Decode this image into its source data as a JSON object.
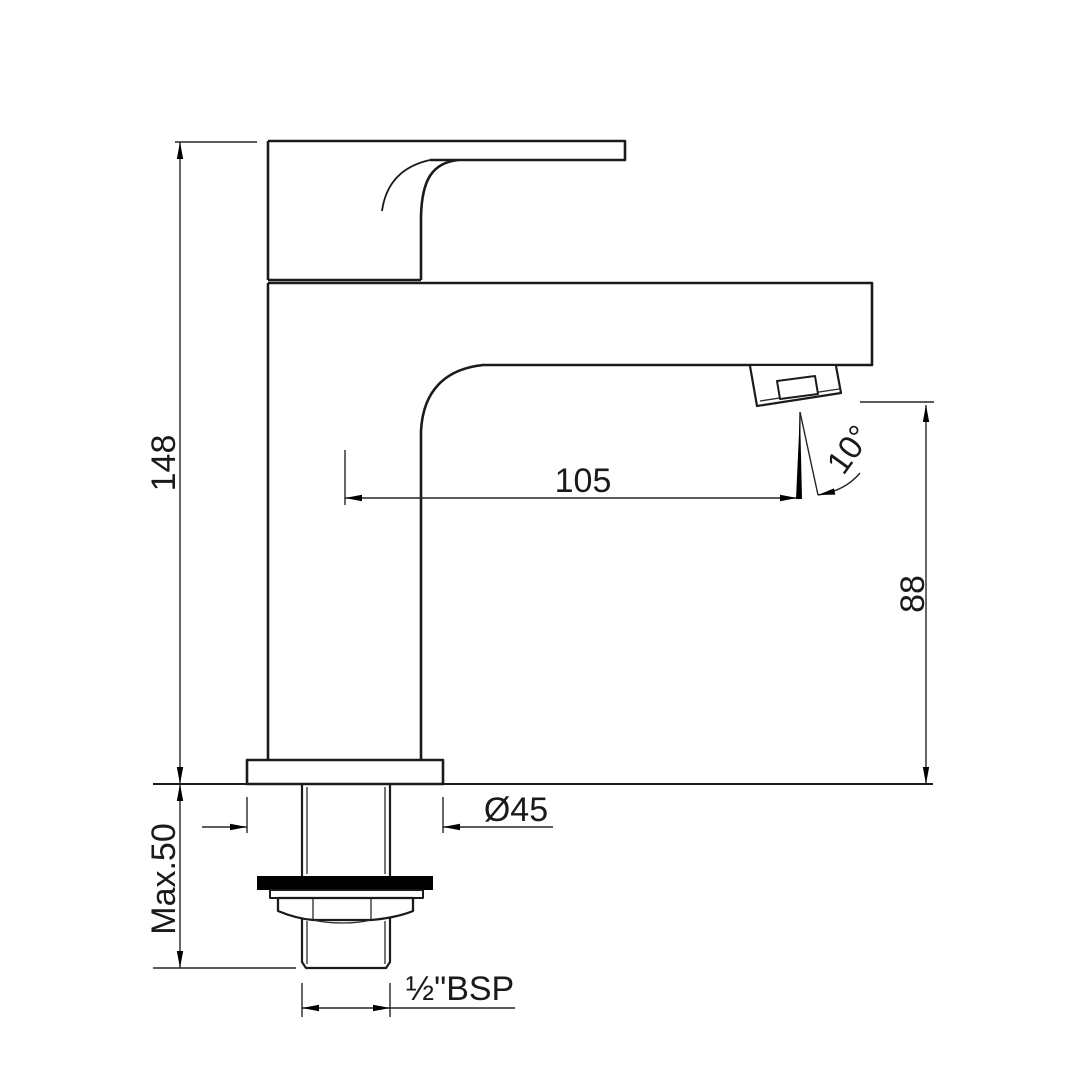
{
  "drawing": {
    "name": "single-lever-basin-mixer-dimension-drawing",
    "dimensions": {
      "height_overall": "148",
      "spout_reach": "105",
      "spout_height": "88",
      "outlet_angle": "10°",
      "base_diameter": "Ø45",
      "max_deck_thickness": "Max.50",
      "inlet_thread": "½\"BSP"
    },
    "colors": {
      "line": "#1b1b1b",
      "dimension_line": "#262626",
      "washer": "#000000",
      "background": "#ffffff"
    }
  }
}
